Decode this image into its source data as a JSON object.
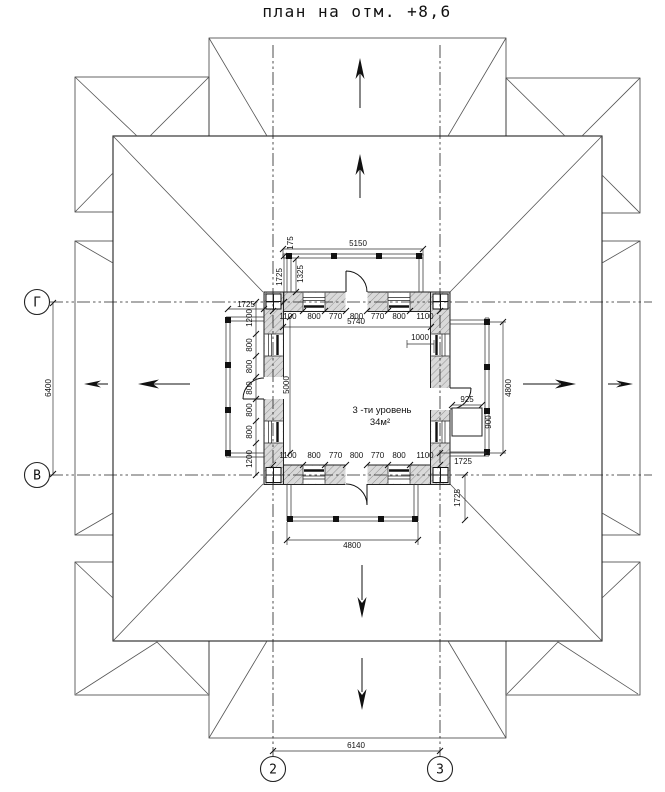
{
  "title": "план на отм. +8,6",
  "axis_markers": {
    "row_top": "Г",
    "row_bottom": "В",
    "col_left": "2",
    "col_right": "3"
  },
  "room": {
    "label": "3 -ти уровень",
    "area": "34м²"
  },
  "dimensions": {
    "axis_width": "6140",
    "axis_height": "6400",
    "top_balcony_width": "5150",
    "top_wall_span": "5740",
    "bottom_balcony_width": "4800",
    "right_balcony_height": "4800",
    "room_side": "5000",
    "top_offset": "1725",
    "left_offset": "1725",
    "bottom_right_offset": "1725",
    "right_offset": "1725",
    "railing_gap": "1325",
    "railing_end": "175",
    "door_niche": "1000",
    "shaft_width": "925",
    "shaft_depth": "900",
    "top_wall_segments": [
      "1100",
      "800",
      "770",
      "800",
      "770",
      "800",
      "1100"
    ],
    "bottom_wall_segments": [
      "1100",
      "800",
      "770",
      "800",
      "770",
      "800",
      "1100"
    ],
    "left_wall_segments": [
      "1200",
      "800",
      "800",
      "800",
      "800",
      "800",
      "1200"
    ]
  }
}
